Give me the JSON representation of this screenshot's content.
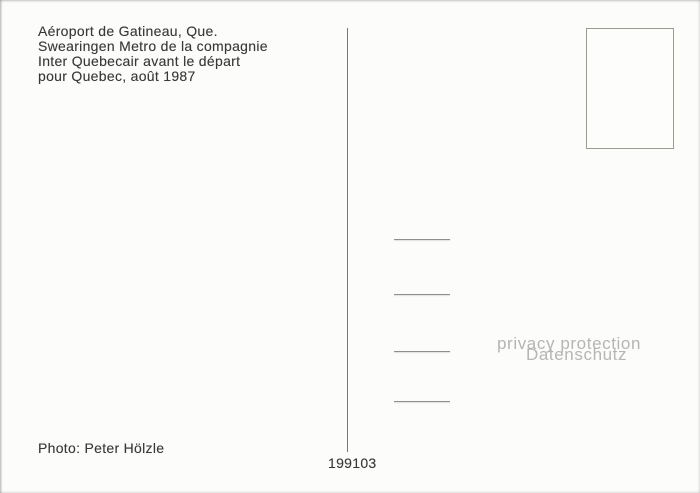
{
  "postcard": {
    "caption": {
      "line1": "Aéroport de Gatineau, Que.",
      "line2": "Swearingen Metro de la compagnie",
      "line3": "Inter Quebecair avant le départ",
      "line4": "pour Quebec, août 1987"
    },
    "watermark": {
      "line1": "privacy protection",
      "line2": "Datenschutz"
    },
    "photo_credit": "Photo: Peter Hölzle",
    "card_number": "199103",
    "address_lines_count": 4,
    "colors": {
      "background": "#fcfcfa",
      "text": "#383838",
      "watermark": "#b5b5b5",
      "divider": "#5f5f5f",
      "address_line": "#8f8f8f",
      "stamp_border": "#9b9b94"
    }
  }
}
